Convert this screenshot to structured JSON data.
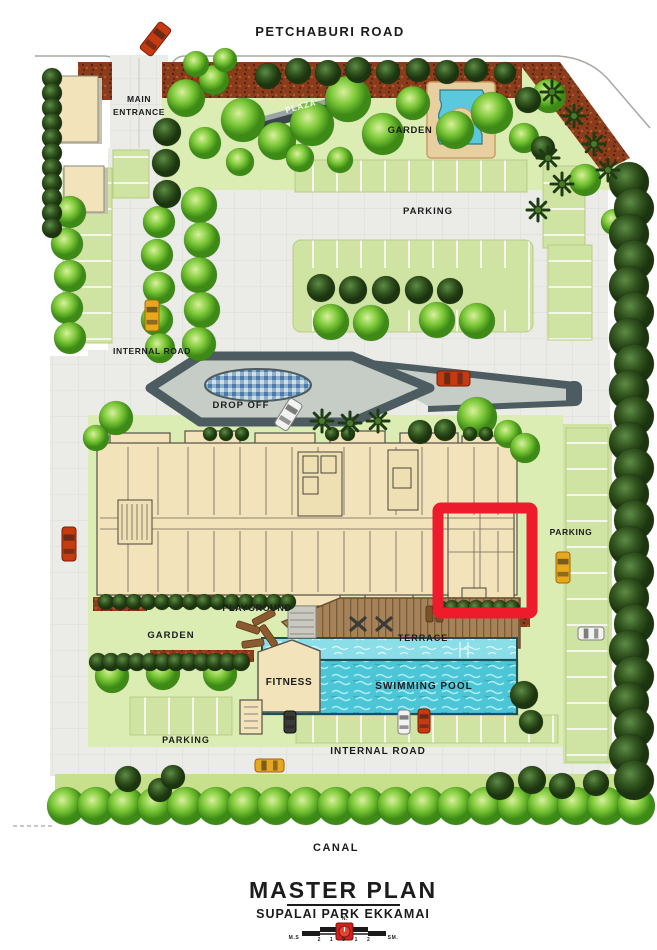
{
  "labels": {
    "petchaburi_road": "PETCHABURI ROAD",
    "main_entrance_line1": "MAIN",
    "main_entrance_line2": "ENTRANCE",
    "plaza": "PLAZA",
    "garden_top": "GARDEN",
    "parking_top": "PARKING",
    "internal_road_top": "INTERNAL ROAD",
    "drop_off": "DROP OFF",
    "parking_right": "PARKING",
    "playground": "PLAYGROUND",
    "garden_bottom": "GARDEN",
    "terrace": "TERRACE",
    "fitness": "FITNESS",
    "swimming_pool": "SWIMMING POOL",
    "parking_bottom": "PARKING",
    "internal_road_bottom": "INTERNAL ROAD",
    "canal": "CANAL"
  },
  "title_block": {
    "title": "MASTER PLAN",
    "subtitle": "SUPALAI PARK EKKAMAI",
    "north_label": "N.",
    "scale_left": "M.S",
    "scale_ticks": "2 1 0 1 2",
    "scale_right": "SM."
  },
  "colors": {
    "highlight_red": "#ee1b2d",
    "pool_blue": "#4cc6d6",
    "lawn_green": "#dcedb4",
    "stall_green": "#cfe3a2",
    "tree_green": "#7cc838",
    "mulch_brown": "#8a3c1c",
    "building_cream": "#f3e3bb",
    "paving_gray": "#ebebe8",
    "dropoff_dark": "#4d5c60",
    "terrace_brown": "#a5825a"
  }
}
